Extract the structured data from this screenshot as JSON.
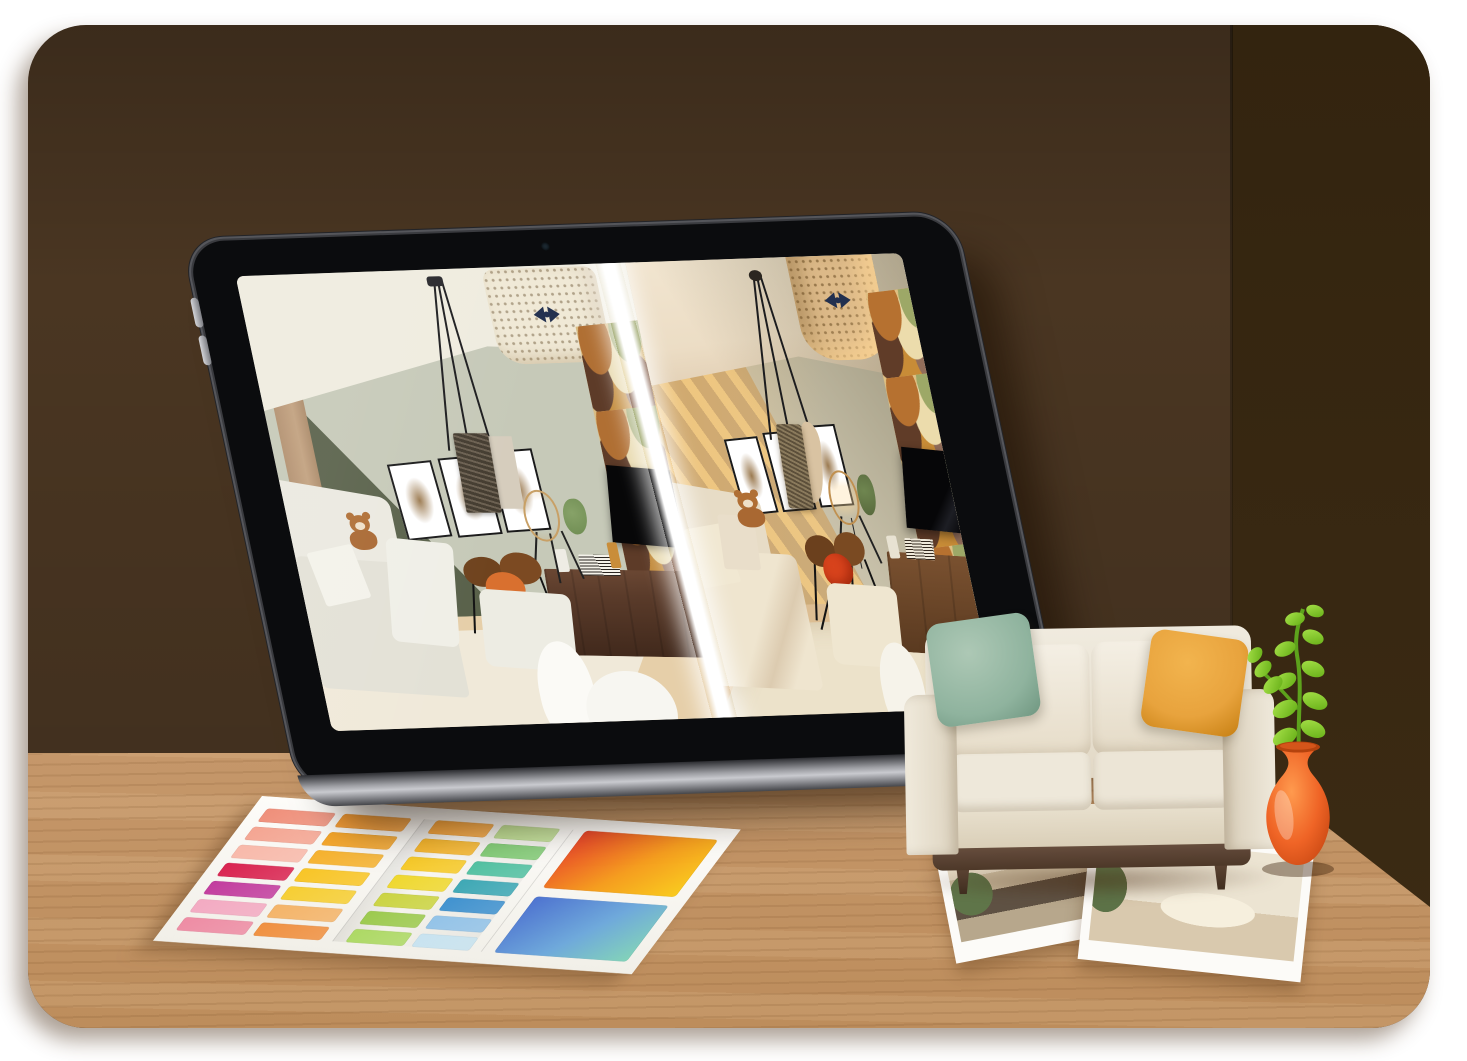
{
  "colors": {
    "page-bg": "#ffffff",
    "wall-front": "#4a3622",
    "wall-side": "#33240f",
    "desk-wood": "#c5976a",
    "tablet-bezel": "#0b0c0e",
    "tablet-rim": "#55565b",
    "tablet-edge": "#c9cacf",
    "screen-divider": "#ffffff",
    "flat-ceiling": "#efecdf",
    "flat-wall": "#c6c9b8",
    "flat-wedge": "#59614a",
    "flat-wood": "#c2a17f",
    "flat-floor": "#e6cfa9",
    "flat-rug": "#f0e9d9",
    "flat-sofa": "#ebe9e0",
    "flat-plantgreen": "#6e8c52",
    "real-ceiling": "#ecddc5",
    "real-wall": "#c9c2ab",
    "real-floor": "#dcbd92",
    "real-rug": "#ece2ca",
    "wallpaper-base": "#d9bc83",
    "wallpaper-caramel": "#b06f33",
    "wallpaper-olive": "#9aa468",
    "wallpaper-cream": "#e7d8ab",
    "wallpaper-brown": "#5d3b28",
    "wallpaper-mauve": "#8d6b59",
    "tv-black": "#070708",
    "frame-border": "#1a1a1a",
    "frame-art": "#9b7a50",
    "drum-flat": "#f0e9d6",
    "drum-real": "#dcb988",
    "bow-navy": "#22304f",
    "teddy-brown": "#b06f35",
    "table-walnut": "#6f431e",
    "table-orange": "#d9702f",
    "stool-red-orange": "#d8431c",
    "cabinet-walnut": "#5a3b2a",
    "lamp-wire": "#c8a066",
    "sofa-cream": "#eee8da",
    "sofa-base-wood": "#5e4637",
    "pillow-green": "#8fb39e",
    "pillow-mustard": "#e8a33d",
    "vase-orange": "#ee6325",
    "plant-green": "#8ccd2f",
    "photo-paper": "#fcfbf8"
  },
  "swatch_sheet": {
    "panels": [
      {
        "name": "pink-orange-swatches",
        "swatches": [
          "#ef8f7a",
          "#f29a33",
          "#f4a592",
          "#f4a428",
          "#f8b9aa",
          "#f6b22e",
          "#d92350",
          "#f8c526",
          "#c23c9e",
          "#f6ce33",
          "#f3aac2",
          "#f4b469",
          "#ee8ca4",
          "#f09040"
        ]
      },
      {
        "name": "yellow-green-blue-swatches",
        "swatches": [
          "#f5a43c",
          "#bede93",
          "#f6b62c",
          "#83cc77",
          "#f7ca28",
          "#52c1a2",
          "#efd82f",
          "#3ea8b5",
          "#cbd442",
          "#4092cf",
          "#9cca4e",
          "#93c3e8",
          "#add964",
          "#c8e3f0"
        ]
      },
      {
        "name": "gradient-tiles",
        "tiles": [
          [
            "#e8452b",
            "#f59d1f",
            "#f9cb1f"
          ],
          [
            "#4e73d0",
            "#6fa9db",
            "#83d3b9"
          ]
        ]
      }
    ]
  },
  "tablet": {
    "screen_split": {
      "left": "flat-2d-room-render",
      "right": "photorealistic-room-render"
    }
  },
  "photos": [
    {
      "name": "kitchen-interior-photo"
    },
    {
      "name": "living-room-interior-photo"
    }
  ]
}
